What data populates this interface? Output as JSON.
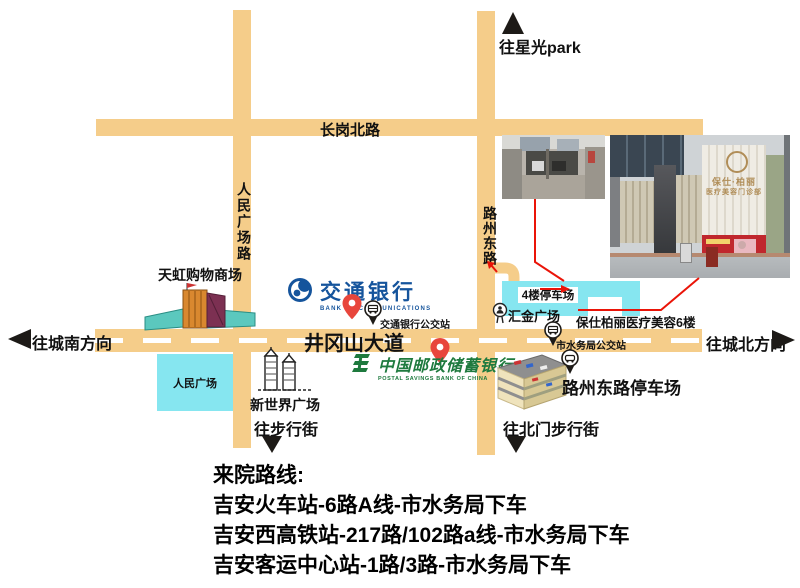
{
  "colors": {
    "road": "#F5CD8A",
    "building_cyan": "#86E6F0",
    "annotation_red": "#EA1408",
    "pin_red": "#E8463C",
    "bocom_blue": "#15549C",
    "psbc_green": "#1E7A3E"
  },
  "map": {
    "toward_star_park": "往星光park",
    "toward_city_south": "往城南方向",
    "toward_city_north": "往城北方向",
    "toward_pedestrian_street": "往步行街",
    "toward_north_gate_street": "往北门步行街",
    "roads": {
      "changgang_north": "长岗北路",
      "renmin_square_road": "人民广场路",
      "luzhou_east_road": "路州东路",
      "jinggangshan_avenue": "井冈山大道"
    },
    "places": {
      "tianhong_mall": "天虹购物商场",
      "people_square": "人民广场",
      "new_world_plaza": "新世界广场",
      "parking_4f": "4楼停车场",
      "huijin_plaza": "汇金广场",
      "clinic_6f": "保仕柏丽医疗美容6楼",
      "luzhou_parking": "路州东路停车场"
    },
    "bocom": {
      "name": "交通银行",
      "en": "BANK OF COMMUNICATIONS",
      "bus_stop": "交通银行公交站"
    },
    "psbc": {
      "name": "中国邮政储蓄银行",
      "en": "POSTAL SAVINGS BANK OF CHINA"
    },
    "water_bureau_bus_stop": "市水务局公交站",
    "photo_sign": {
      "line1": "保仕·柏丽",
      "line2": "医疗美容门诊部"
    }
  },
  "routes": {
    "title": "来院路线:",
    "lines": [
      "吉安火车站-6路A线-市水务局下车",
      "吉安西高铁站-217路/102路a线-市水务局下车",
      "吉安客运中心站-1路/3路-市水务局下车"
    ]
  }
}
